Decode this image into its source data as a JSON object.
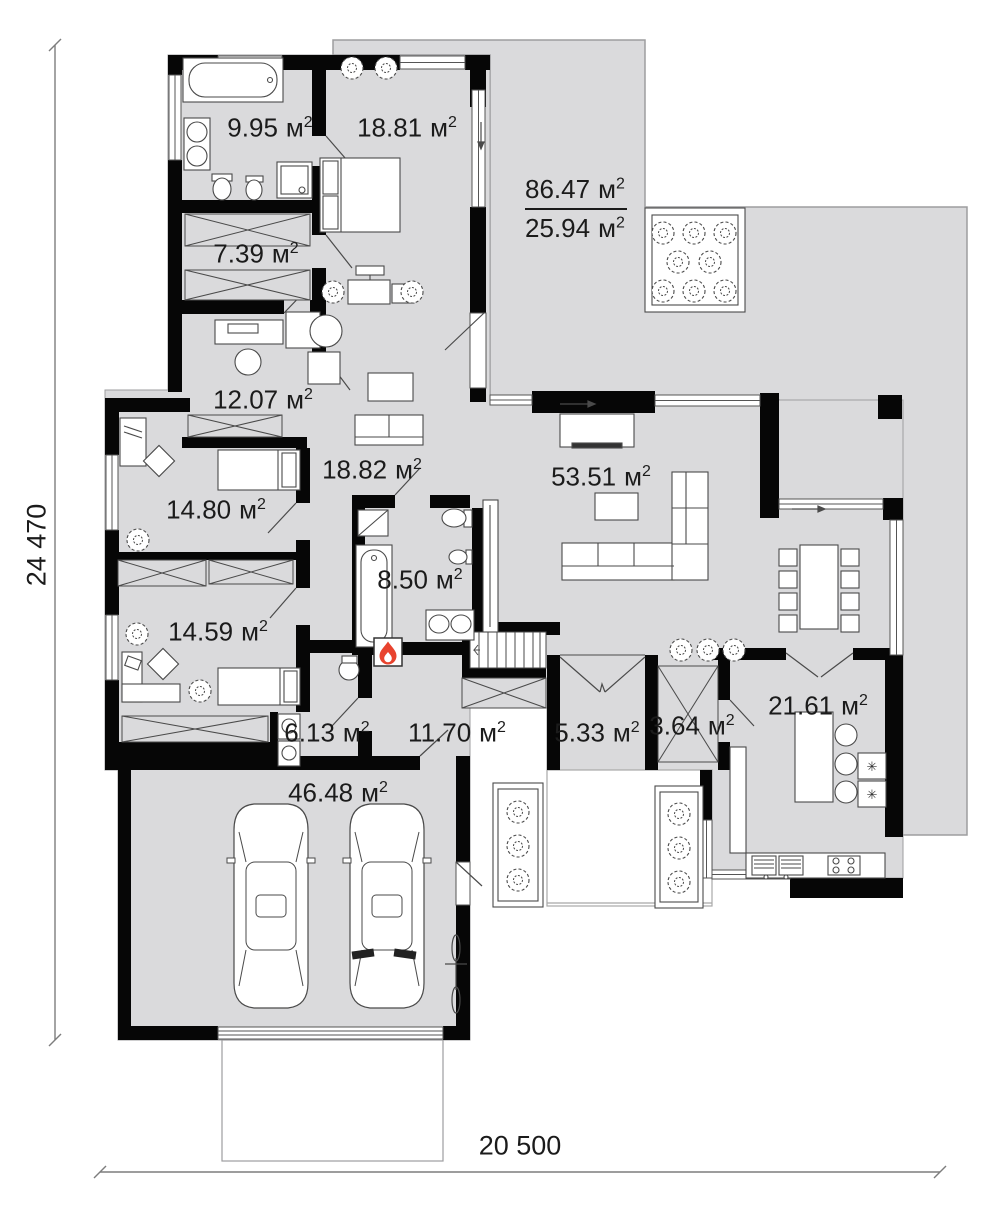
{
  "rooms": [
    {
      "value": "9.95",
      "unit": "м",
      "sup": "2"
    },
    {
      "value": "18.81",
      "unit": "м",
      "sup": "2"
    },
    {
      "value": "7.39",
      "unit": "м",
      "sup": "2"
    },
    {
      "value": "12.07",
      "unit": "м",
      "sup": "2"
    },
    {
      "value": "18.82",
      "unit": "м",
      "sup": "2"
    },
    {
      "value": "14.80",
      "unit": "м",
      "sup": "2"
    },
    {
      "value": "53.51",
      "unit": "м",
      "sup": "2"
    },
    {
      "value": "8.50",
      "unit": "м",
      "sup": "2"
    },
    {
      "value": "14.59",
      "unit": "м",
      "sup": "2"
    },
    {
      "value": "6.13",
      "unit": "м",
      "sup": "2"
    },
    {
      "value": "11.70",
      "unit": "м",
      "sup": "2"
    },
    {
      "value": "5.33",
      "unit": "м",
      "sup": "2"
    },
    {
      "value": "3.64",
      "unit": "м",
      "sup": "2"
    },
    {
      "value": "21.61",
      "unit": "м",
      "sup": "2"
    },
    {
      "value": "46.48",
      "unit": "м",
      "sup": "2"
    }
  ],
  "terrace_label": {
    "total_value": "86.47",
    "total_unit": "м",
    "total_sup": "2",
    "covered_value": "25.94",
    "covered_unit": "м",
    "covered_sup": "2"
  },
  "dimensions": {
    "height_mm": "24 470",
    "width_mm": "20 500"
  },
  "symbols": {
    "appliance_star": "✳"
  },
  "colors": {
    "floor": "#dadadc",
    "wall": "#060606",
    "flame": "#e8432e",
    "line": "#4a4a4a"
  }
}
